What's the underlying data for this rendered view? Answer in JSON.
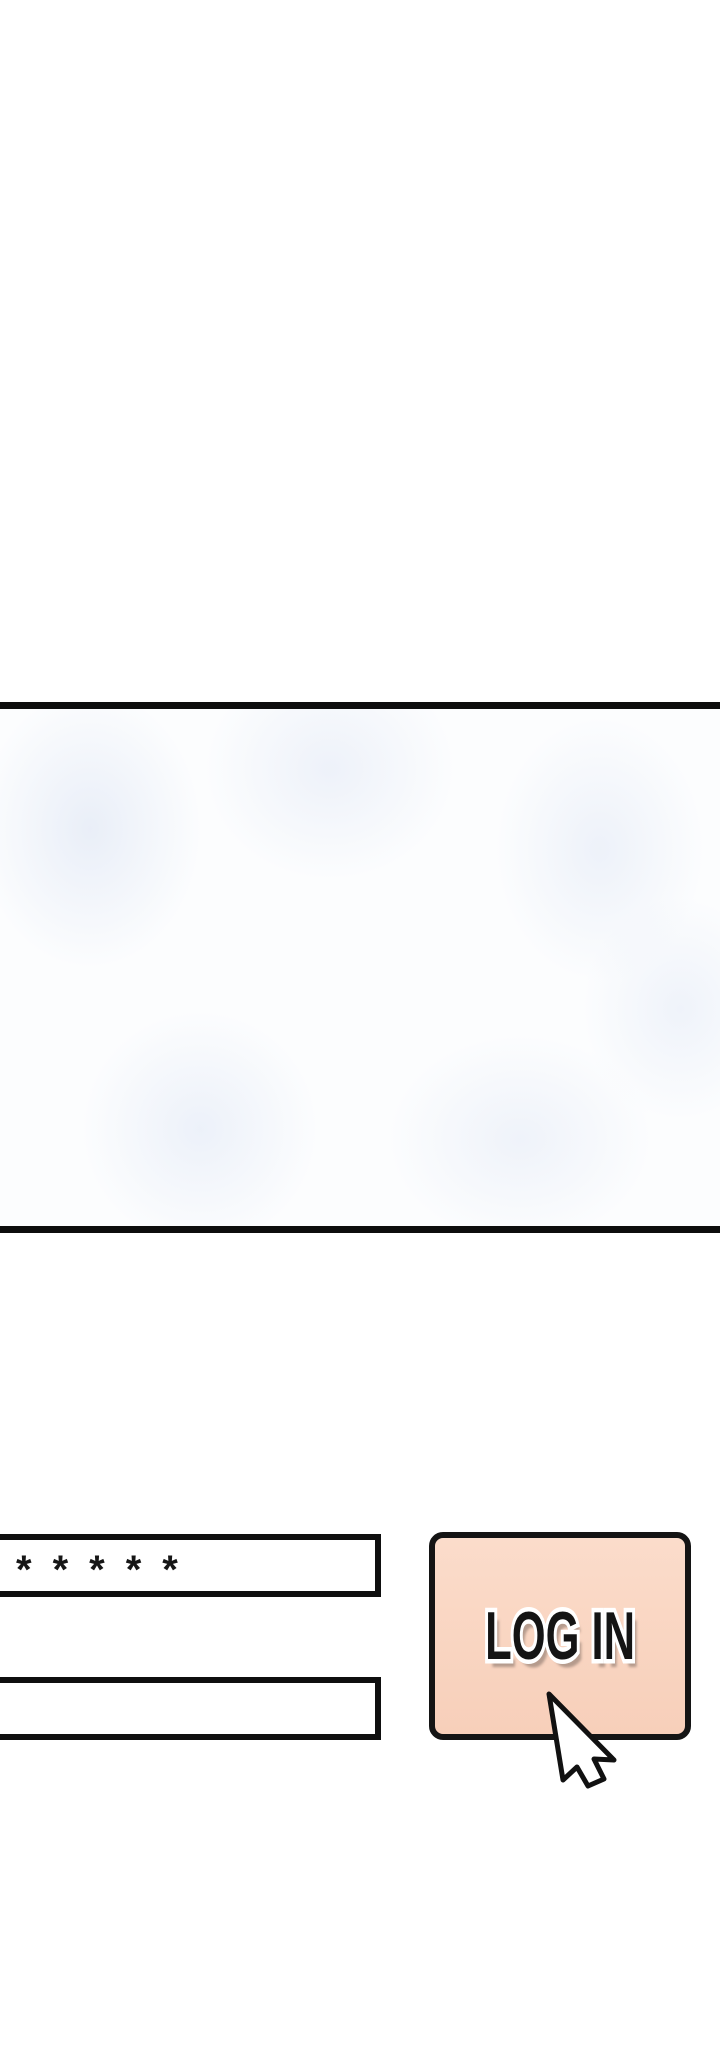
{
  "panel": {
    "border_color": "#0d0d0d",
    "background": "#fcfdfe",
    "form": {
      "password_field": {
        "masked_value": "*****",
        "display_masked": "*****",
        "border_color": "#0f0f0f"
      },
      "text_field": {
        "value": "",
        "border_color": "#0f0f0f"
      },
      "login_button": {
        "label": "LOG IN",
        "fill_color": "#f9d5c1",
        "border_color": "#141414",
        "text_color": "#141414",
        "text_outline_color": "#ffffff"
      }
    },
    "cursor": {
      "icon": "arrow-pointer",
      "fill": "#ffffff",
      "outline": "#111111"
    }
  }
}
